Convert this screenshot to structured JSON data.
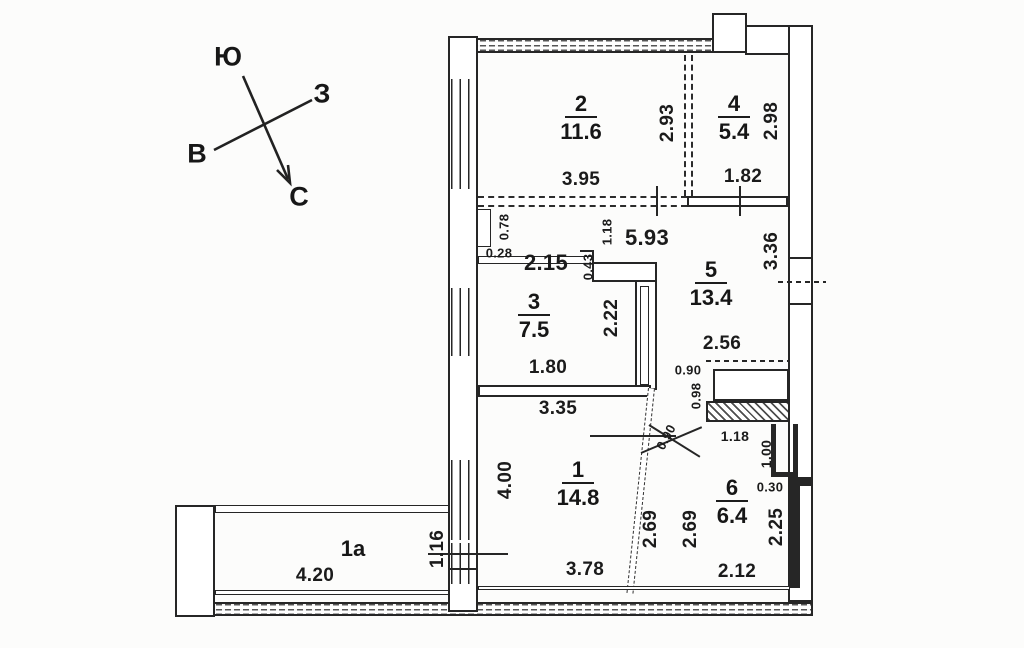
{
  "compass": {
    "south": "Ю",
    "west": "З",
    "east": "В",
    "north": "С"
  },
  "rooms": {
    "r1": {
      "number": "1",
      "area": "14.8"
    },
    "r1a": {
      "number": "1а"
    },
    "r2": {
      "number": "2",
      "area": "11.6"
    },
    "r3": {
      "number": "3",
      "area": "7.5"
    },
    "r4": {
      "number": "4",
      "area": "5.4"
    },
    "r5": {
      "number": "5",
      "area": "13.4"
    },
    "r6": {
      "number": "6",
      "area": "6.4"
    }
  },
  "dimensions": {
    "room2_width": "3.95",
    "room2_depth": "2.93",
    "room4_width": "1.82",
    "room4_depth": "2.98",
    "corridor_length": "5.93",
    "corridor_width": "1.18",
    "hall_width": "2.15",
    "niche_depth": "0.78",
    "niche_width": "0.28",
    "wall_step": "0.43",
    "room5_side": "3.36",
    "room5_width": "2.56",
    "closet_opening": "0.90",
    "closet_depth": "0.98",
    "room3_width": "1.80",
    "room3_wall": "2.22",
    "room3_length": "3.35",
    "room1_depth": "4.00",
    "room1_width": "3.78",
    "partition_left": "2.69",
    "partition_right": "2.69",
    "room6_width": "2.12",
    "room6_depth": "2.25",
    "door_width": "0.90",
    "niche6_width": "1.18",
    "niche6_depth": "1.00",
    "ledge": "0.30",
    "balcony_length": "4.20",
    "balcony_width": "1.16"
  }
}
